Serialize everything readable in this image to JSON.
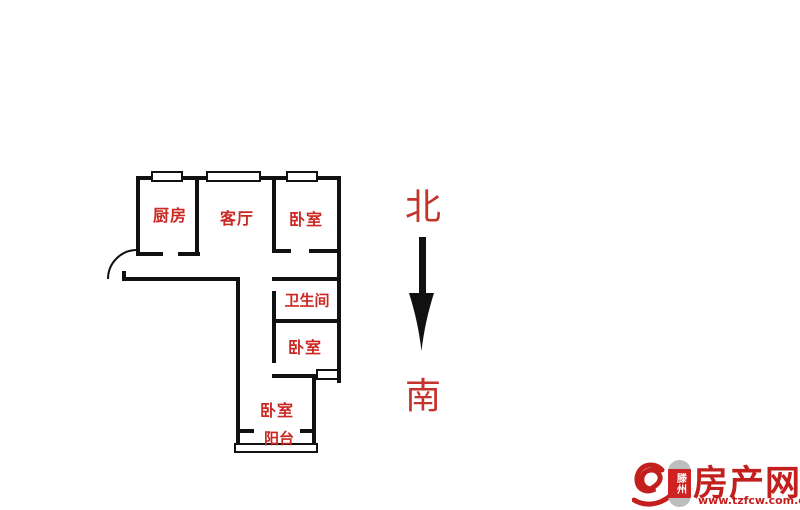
{
  "floorplan": {
    "rooms": [
      {
        "id": "kitchen",
        "label": "厨房"
      },
      {
        "id": "living-room",
        "label": "客厅"
      },
      {
        "id": "bedroom-north",
        "label": "卧室"
      },
      {
        "id": "bathroom",
        "label": "卫生间"
      },
      {
        "id": "bedroom-middle",
        "label": "卧室"
      },
      {
        "id": "bedroom-south",
        "label": "卧室"
      },
      {
        "id": "balcony",
        "label": "阳台"
      }
    ]
  },
  "compass": {
    "north_label": "北",
    "south_label": "南"
  },
  "logo": {
    "city": "滕州",
    "site": "房产网",
    "url": "www.tzfcw.com.cn"
  },
  "colors": {
    "wall_black": "#111111",
    "room_label_red": "#cb2823",
    "compass_red": "#c5342c",
    "logo_red": "#c41f1f",
    "badge_red": "#cf2222",
    "badge_cap_gray": "#bdbdbd"
  }
}
